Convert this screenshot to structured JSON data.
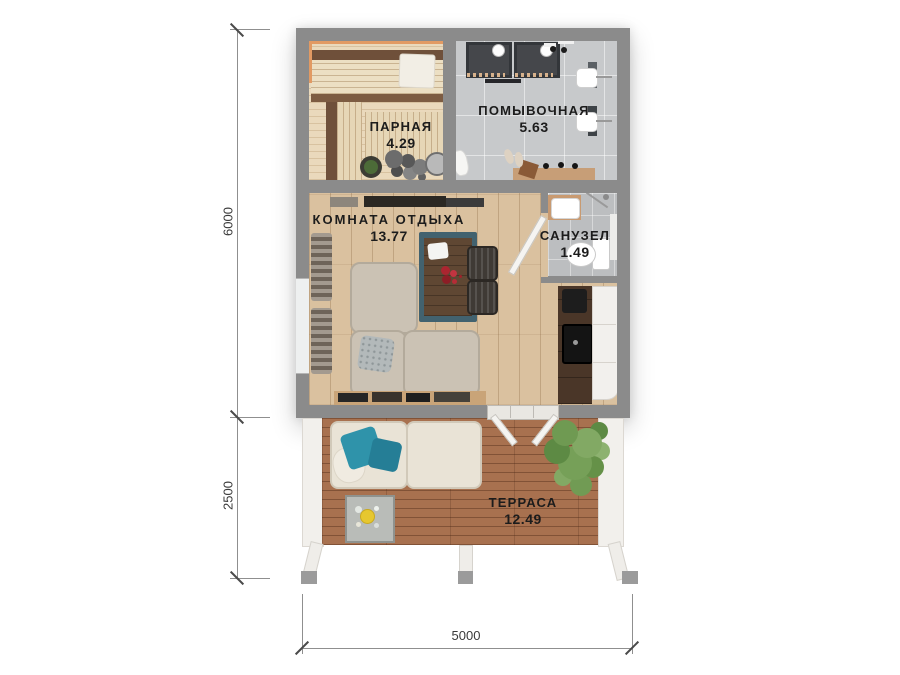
{
  "plan": {
    "rooms": [
      {
        "key": "parnaya",
        "name": "ПАРНАЯ",
        "area": "4.29"
      },
      {
        "key": "pomyvochnaya",
        "name": "ПОМЫВОЧНАЯ",
        "area": "5.63"
      },
      {
        "key": "komnata_otdyha",
        "name": "КОМНАТА ОТДЫХА",
        "area": "13.77"
      },
      {
        "key": "sanuzel",
        "name": "САНУЗЕЛ",
        "area": "1.49"
      },
      {
        "key": "terrasa",
        "name": "ТЕРРАСА",
        "area": "12.49"
      }
    ],
    "dimensions": {
      "height_main": "6000",
      "height_terrace": "2500",
      "width": "5000"
    },
    "colors": {
      "wall": "#8b8b8b",
      "sauna_wood": "#ead9bc",
      "tile": "#c7c9cb",
      "wood_floor": "#dac19f",
      "deck": "#a8714f",
      "accent_pillow": "#2f93aa",
      "label_text": "#1c1c1c",
      "dimension_text": "#3a3a3a"
    }
  }
}
